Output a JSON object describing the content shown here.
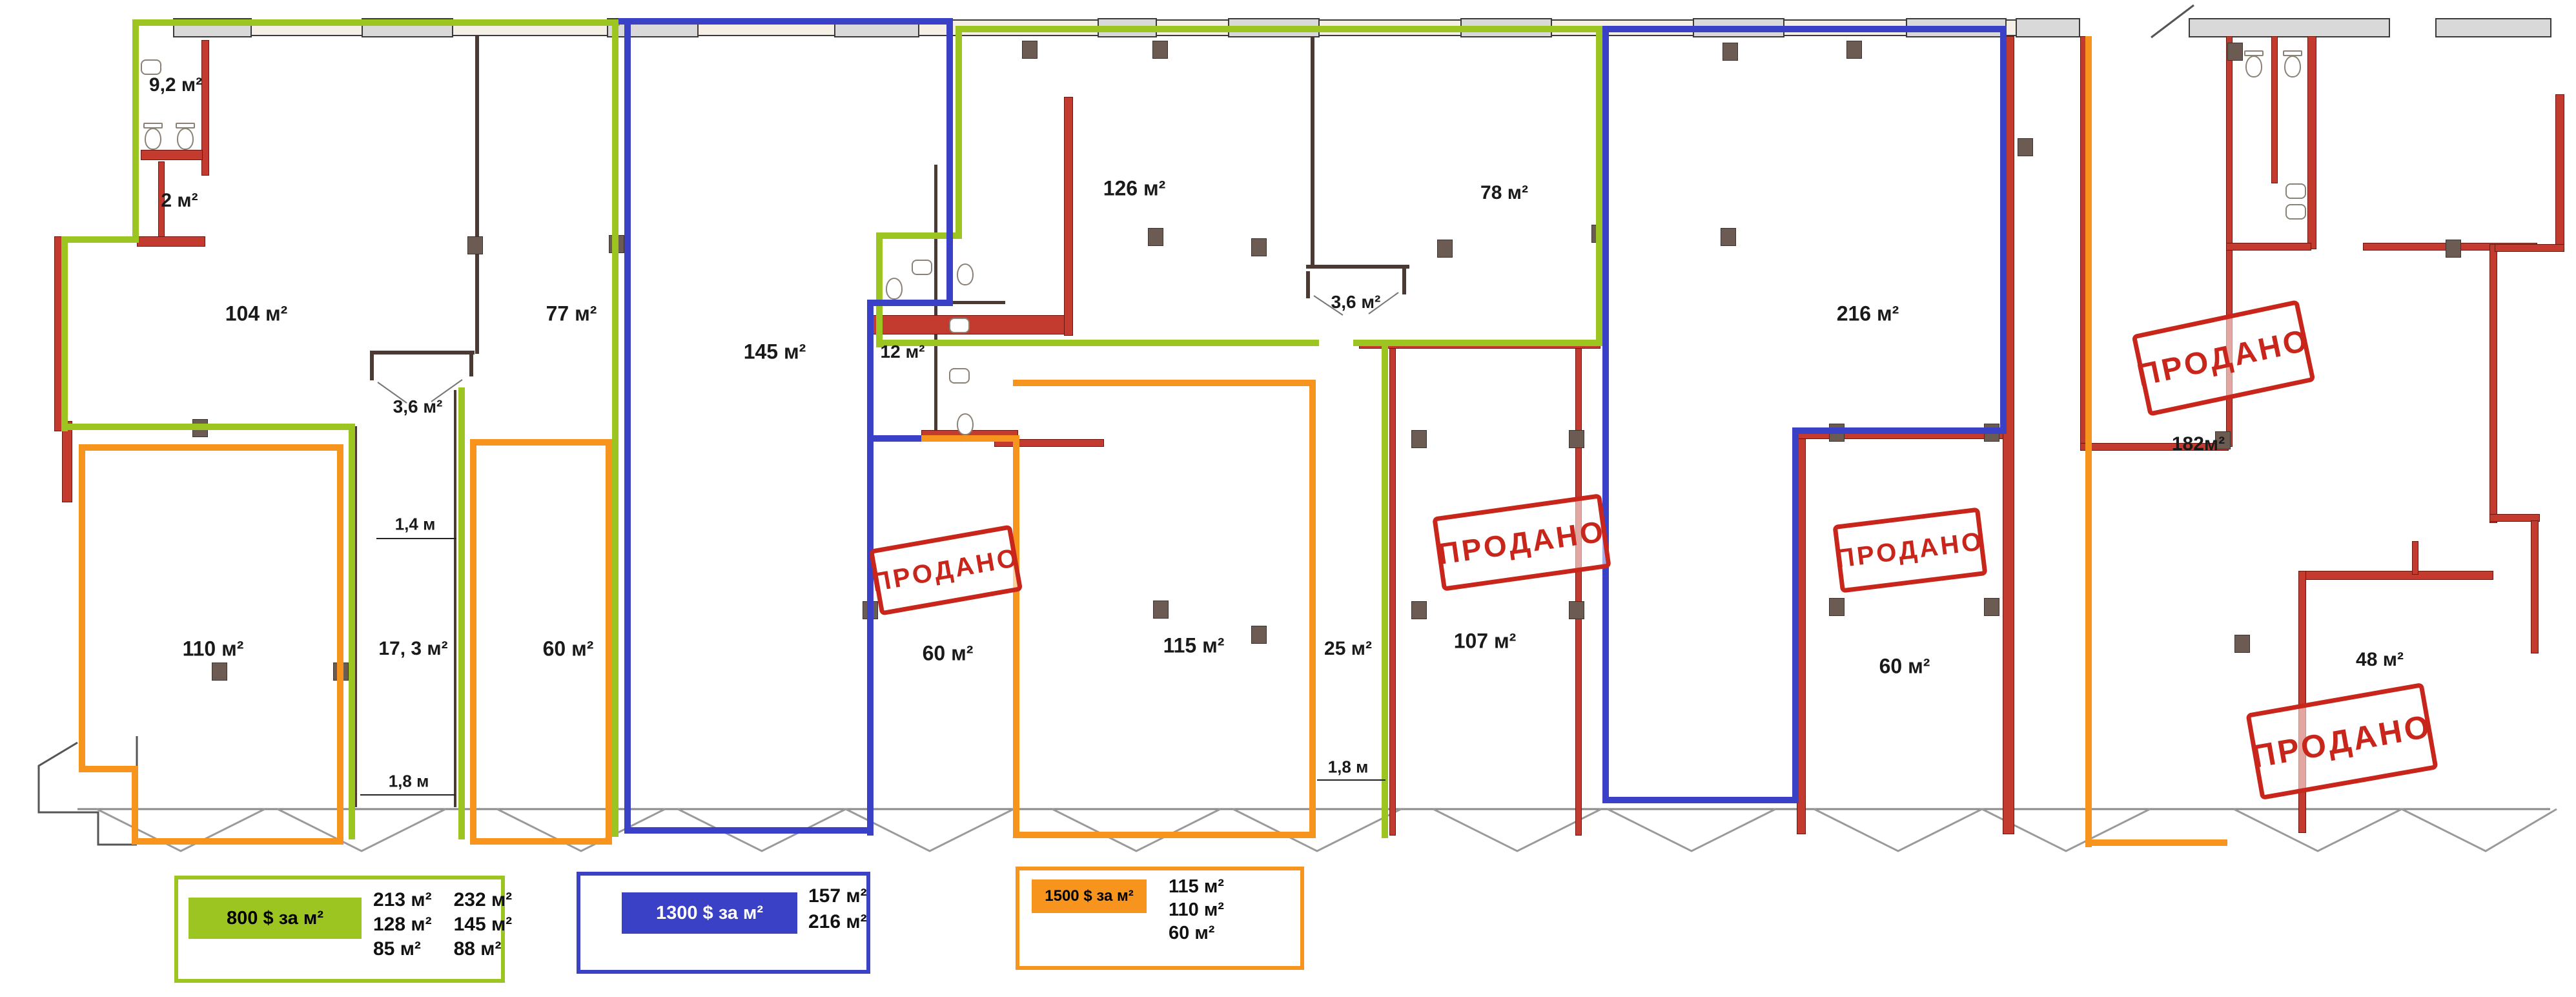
{
  "stamp_text": "ПРОДАНО",
  "rooms": [
    {
      "label": "9,2 м²"
    },
    {
      "label": "2 м²"
    },
    {
      "label": "104 м²"
    },
    {
      "label": "77 м²"
    },
    {
      "label": "3,6 м²"
    },
    {
      "label": "110 м²"
    },
    {
      "label": "17, 3 м²"
    },
    {
      "label": "60 м²"
    },
    {
      "label": "145 м²"
    },
    {
      "label": "12 м²"
    },
    {
      "label": "126 м²"
    },
    {
      "label": "60 м²"
    },
    {
      "label": "115 м²"
    },
    {
      "label": "3,6 м²"
    },
    {
      "label": "25 м²"
    },
    {
      "label": "78 м²"
    },
    {
      "label": "107 м²"
    },
    {
      "label": "216 м²"
    },
    {
      "label": "60 м²"
    },
    {
      "label": "182м²"
    },
    {
      "label": "48 м²"
    }
  ],
  "dims": [
    {
      "label": "1,4 м"
    },
    {
      "label": "1,8 м"
    },
    {
      "label": "1,8 м"
    }
  ],
  "legends": [
    {
      "price": "800 $ за м²",
      "areas_col1": [
        "213 м²",
        "128 м²",
        "85 м²"
      ],
      "areas_col2": [
        "232 м²",
        "145 м²",
        "88 м²"
      ],
      "color": "#9DC522",
      "chip_text_color": "#000000"
    },
    {
      "price": "1300 $ за м²",
      "areas_col1": [
        "157 м²",
        "216 м²"
      ],
      "areas_col2": [],
      "color": "#3A41C6",
      "chip_text_color": "#FFFFFF"
    },
    {
      "price": "1500 $ за м²",
      "areas_col1": [
        "115 м²",
        "110 м²",
        "60 м²"
      ],
      "areas_col2": [],
      "color": "#F7941E",
      "chip_text_color": "#000000"
    }
  ],
  "colors": {
    "zone_800": "#9DC522",
    "zone_1300": "#3A41C6",
    "zone_1500": "#F7941E",
    "sold_stamp": "#C8251B",
    "red_wall": "#C23B2E",
    "wall_band": "#D9D9D9"
  }
}
